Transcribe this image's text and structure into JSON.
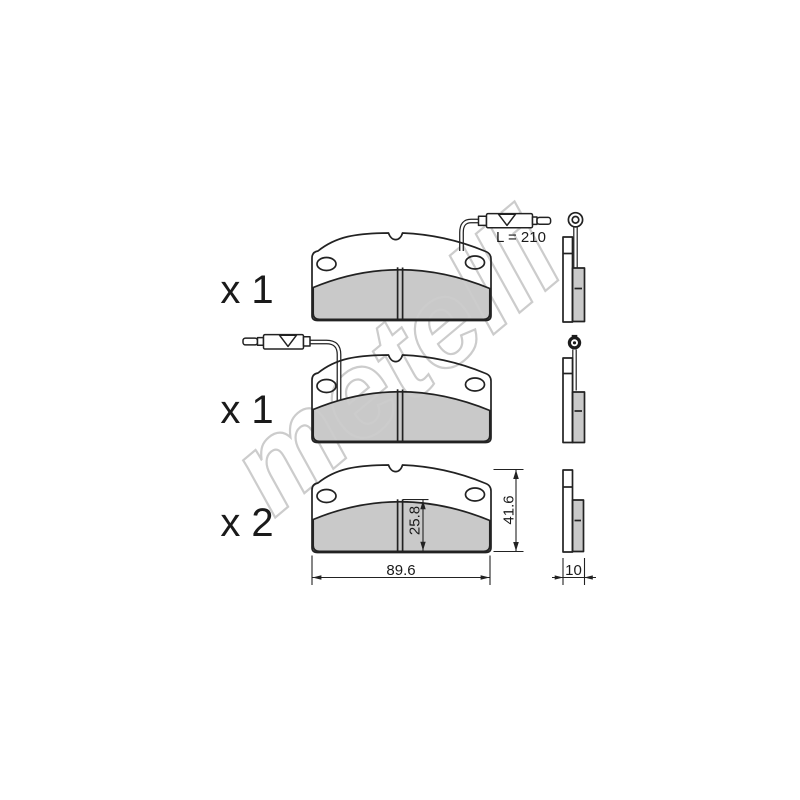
{
  "drawing": {
    "kind": "brake-pad-set-technical-drawing",
    "watermark": "metelli",
    "views": [
      {
        "id": "pad-with-right-wear-sensor",
        "quantity_label": "x 1",
        "wire_side": "right",
        "wire_length_label": "L = 210"
      },
      {
        "id": "pad-with-left-wear-sensor",
        "quantity_label": "x 1",
        "wire_side": "left"
      },
      {
        "id": "pad-without-sensor",
        "quantity_label": "x 2"
      }
    ],
    "dimensions": {
      "wire_length": "L = 210",
      "pad_height": "41.6",
      "friction_height": "25.8",
      "pad_width": "89.6",
      "pad_thickness": "10"
    },
    "colors": {
      "line": "#222222",
      "friction_fill": "#c9c9c9",
      "watermark": "#cccccc",
      "background": "#ffffff"
    }
  }
}
